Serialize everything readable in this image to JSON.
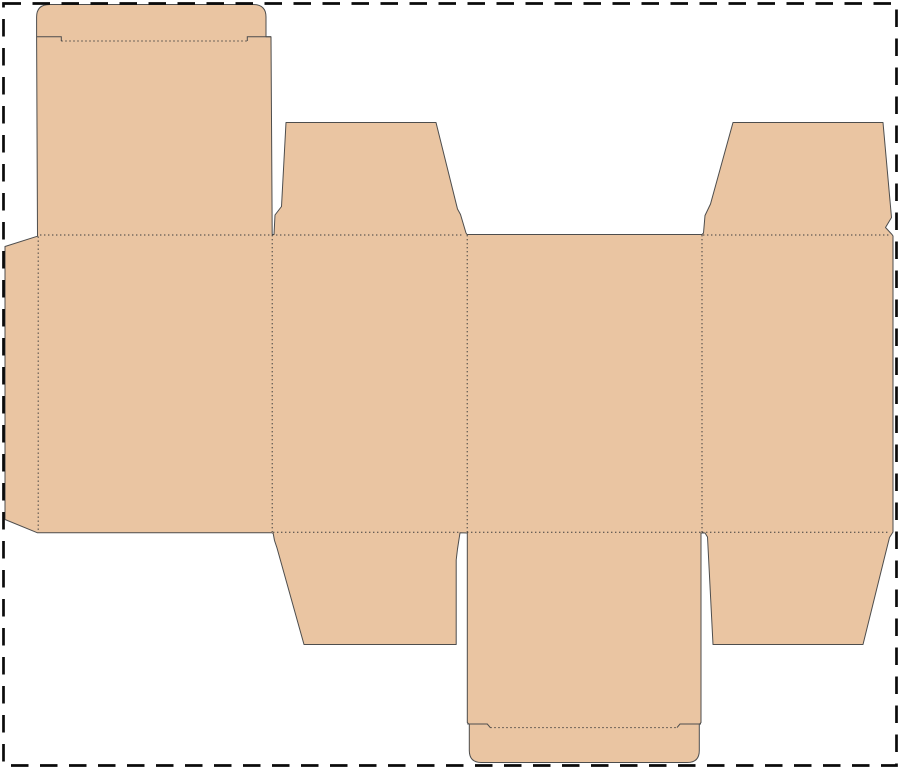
{
  "page": {
    "background": "#ffffff",
    "width_px": 900,
    "height_px": 769
  },
  "dieline": {
    "description": "flat folding-carton box dieline with tuck flaps, dust flaps and glue flap",
    "panel_fill": "#eac5a2",
    "cut_line": {
      "color": "#4d4d4d",
      "width": 1
    },
    "fold_line": {
      "color": "#3d3d3d",
      "width": 1,
      "dash": "1.4 2.6"
    },
    "sheet_border": {
      "color": "#0b0b0b",
      "width": 2.7,
      "dash": "17.5 11.5",
      "x": 3.5,
      "y": 3.5,
      "w": 893,
      "h": 762
    },
    "outline_path": "M 49.6 4.5 L 253 4.5 Q 266 4.5 266 17 L 266 36.7 L 271 36.7 L 272.2 234.5 L 274 234.5 L 275 215 L 281.5 206.5 L 286 122.5 L 436 122.5 L 457.5 209 L 460.5 214.5 L 466 233 L 467 234.5 L 702 234.5 L 703.5 233 L 705 215.5 L 710.5 204 L 733 122.5 L 883 122.5 L 891.5 217.5 L 885.5 227.5 L 892 234.5 L 893 236 L 893 532 L 889.5 537.5 L 885 555.5 L 863 644.5 L 713 644.5 L 707.5 537 L 705 533 L 701 533 L 701 722.5 L 699.3 724.5 L 699.3 750.5 Q 699.3 762.5 687.3 762.5 L 481.3 762.5 Q 469.3 762.5 469.3 750.5 L 469.3 724.5 L 467.3 722.5 L 467.3 533 L 460 532.8 L 457.5 549 L 456.2 560 L 456.2 644.5 L 304 644.5 L 277 548 L 274.5 540.5 L 273.2 533.5 L 272 532.8 L 37.5 532.8 L 5 519.5 L 5 246.5 L 37.5 236.2 L 36.6 37 L 36.6 17 Q 36.6 4.5 49.6 4.5 Z",
    "shoulder_cut_paths": [
      "M 36.8 36.7 L 61.3 36.7 L 61.3 41",
      "M 247.3 41 L 247.3 36.7 L 271 36.7",
      "M 467.3 724 L 487.3 724 L 490.3 727.6",
      "M 677 727.6 L 680 724 L 701 724"
    ],
    "fold_line_paths": [
      "M 61.3 41 L 247.3 41",
      "M 40 235 L 462 235",
      "M 703 235 L 890 235",
      "M 38.2 236.5 L 38.2 531",
      "M 272.2 235 L 272.2 532",
      "M 467.2 235 L 467.2 532",
      "M 702 235 L 702 532",
      "M 273 532.3 L 459 532.3",
      "M 467 532.3 L 701 532.3",
      "M 702 532.3 L 888 532.3",
      "M 490.3 727.6 L 677 727.6"
    ]
  }
}
